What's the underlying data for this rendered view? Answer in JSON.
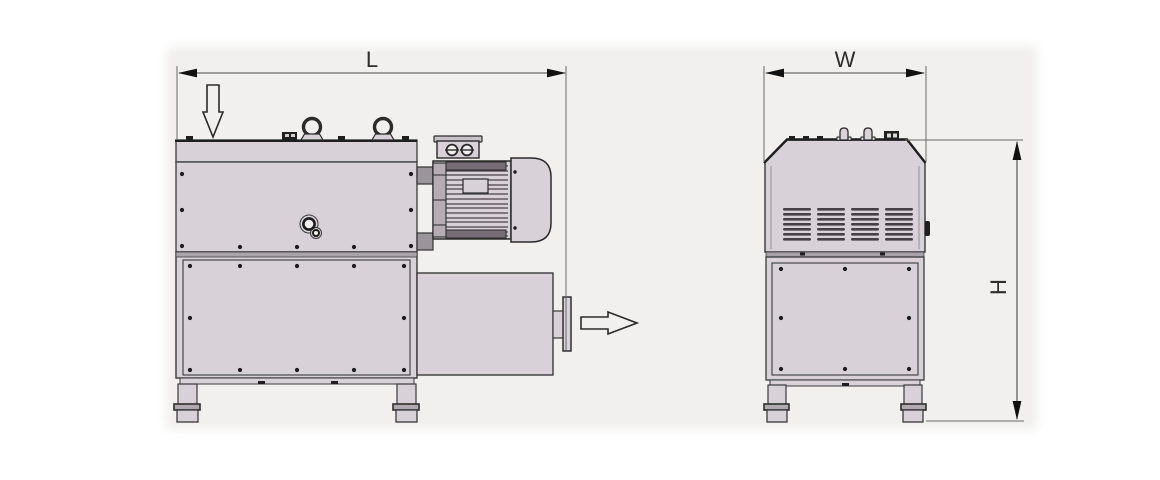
{
  "diagram": {
    "dimensions": {
      "length_label": "L",
      "width_label": "W",
      "height_label": "H"
    },
    "icons": {
      "inlet_arrow": "arrow-down-outline",
      "outlet_arrow": "arrow-right-outline"
    },
    "colors": {
      "canvas": "#f1f0ee",
      "body": "#d8d1d8",
      "line": "#3a3a3a",
      "dimension_line": "#4a4a4a",
      "label": "#2d2d2d",
      "dark_detail": "#1f1f1f"
    }
  }
}
